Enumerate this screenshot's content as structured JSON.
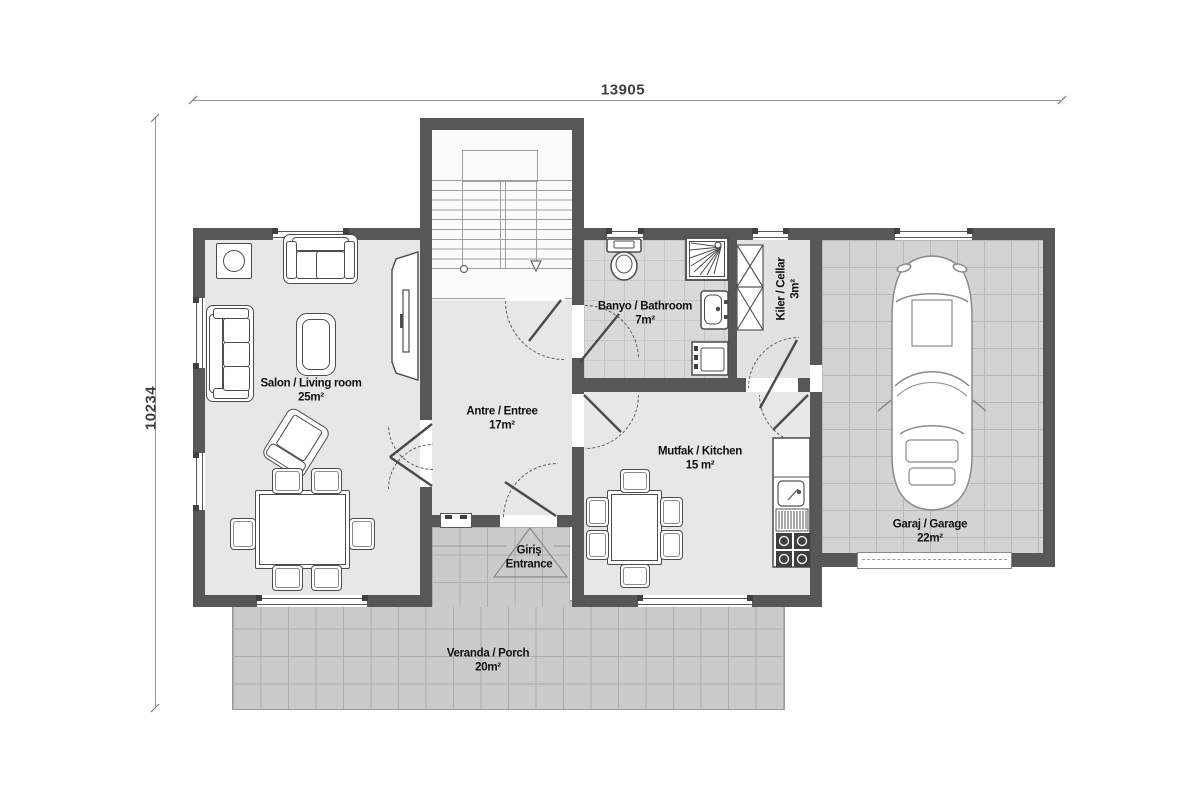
{
  "plan_title": "floor-plan",
  "dimensions": {
    "width_label": "13905",
    "height_label": "10234"
  },
  "rooms": [
    {
      "name": "Salon / Living room",
      "area": "25m²"
    },
    {
      "name": "Antre / Entree",
      "area": "17m²"
    },
    {
      "name": "Banyo / Bathroom",
      "area": "7m²"
    },
    {
      "name": "Kiler / Cellar",
      "area": "3m²"
    },
    {
      "name": "Mutfak / Kitchen",
      "area": "15 m²"
    },
    {
      "name": "Garaj / Garage",
      "area": "22m²"
    },
    {
      "name": "Veranda / Porch",
      "area": "20m²"
    }
  ],
  "entrance": {
    "line1": "Giriş",
    "line2": "Entrance"
  },
  "colors": {
    "wall": "#575757",
    "room_fill": "#e7e7e7",
    "bath_fill": "#d9d9d9",
    "garage_fill": "#d3d3d3",
    "porch_fill": "#cbcbcb",
    "text": "#111111"
  }
}
